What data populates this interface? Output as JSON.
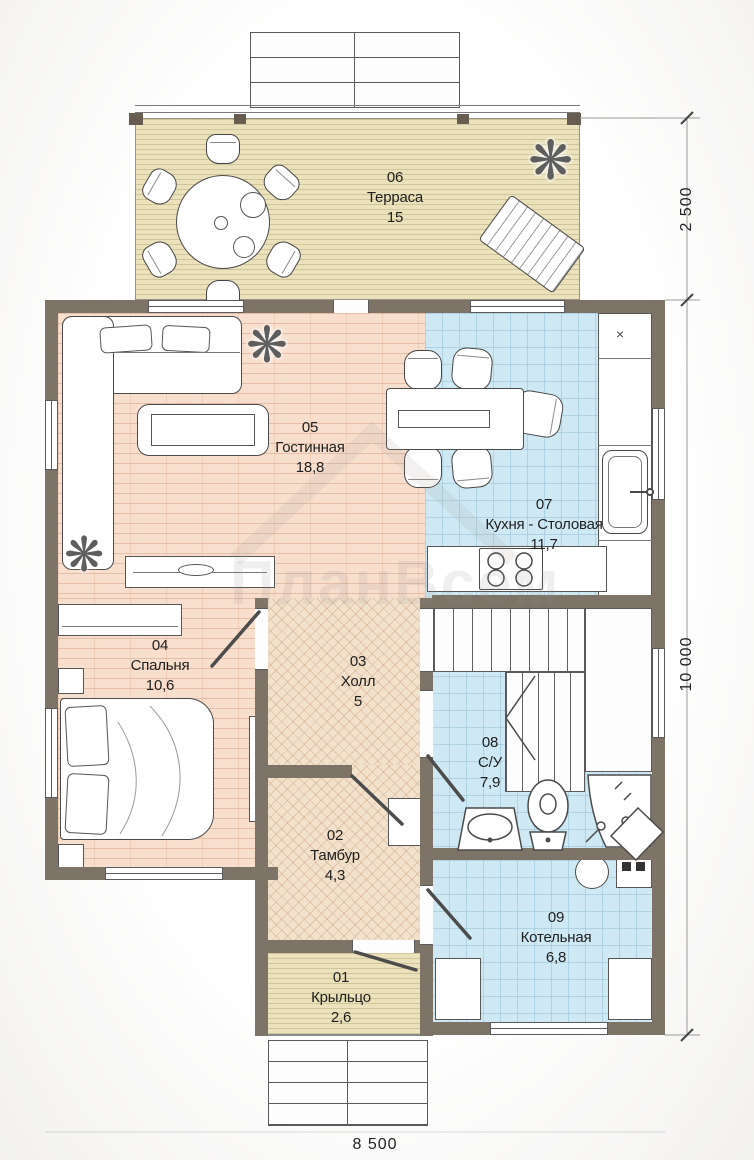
{
  "watermark": "ПланВсем",
  "rooms": [
    {
      "id": "01",
      "name": "Крыльцо",
      "area": "2,6"
    },
    {
      "id": "02",
      "name": "Тамбур",
      "area": "4,3"
    },
    {
      "id": "03",
      "name": "Холл",
      "area": "5"
    },
    {
      "id": "04",
      "name": "Спальня",
      "area": "10,6"
    },
    {
      "id": "05",
      "name": "Гостинная",
      "area": "18,8"
    },
    {
      "id": "06",
      "name": "Терраса",
      "area": "15"
    },
    {
      "id": "07",
      "name": "Кухня - Столовая",
      "area": "11,7"
    },
    {
      "id": "08",
      "name": "С/У",
      "area": "7,9"
    },
    {
      "id": "09",
      "name": "Котельная",
      "area": "6,8"
    }
  ],
  "dimensions": {
    "terrace_depth": "2 500",
    "house_length": "10 000",
    "house_width": "8 500"
  },
  "icons": {
    "plant": "❋",
    "cabinet_cross": "×"
  },
  "colors": {
    "wall": "#7d7367",
    "deck": "#ebe2bc",
    "brick_floor": "#f8dfcd",
    "tile_floor": "#cfe9f4",
    "parquet_floor": "#f2e2cc"
  }
}
